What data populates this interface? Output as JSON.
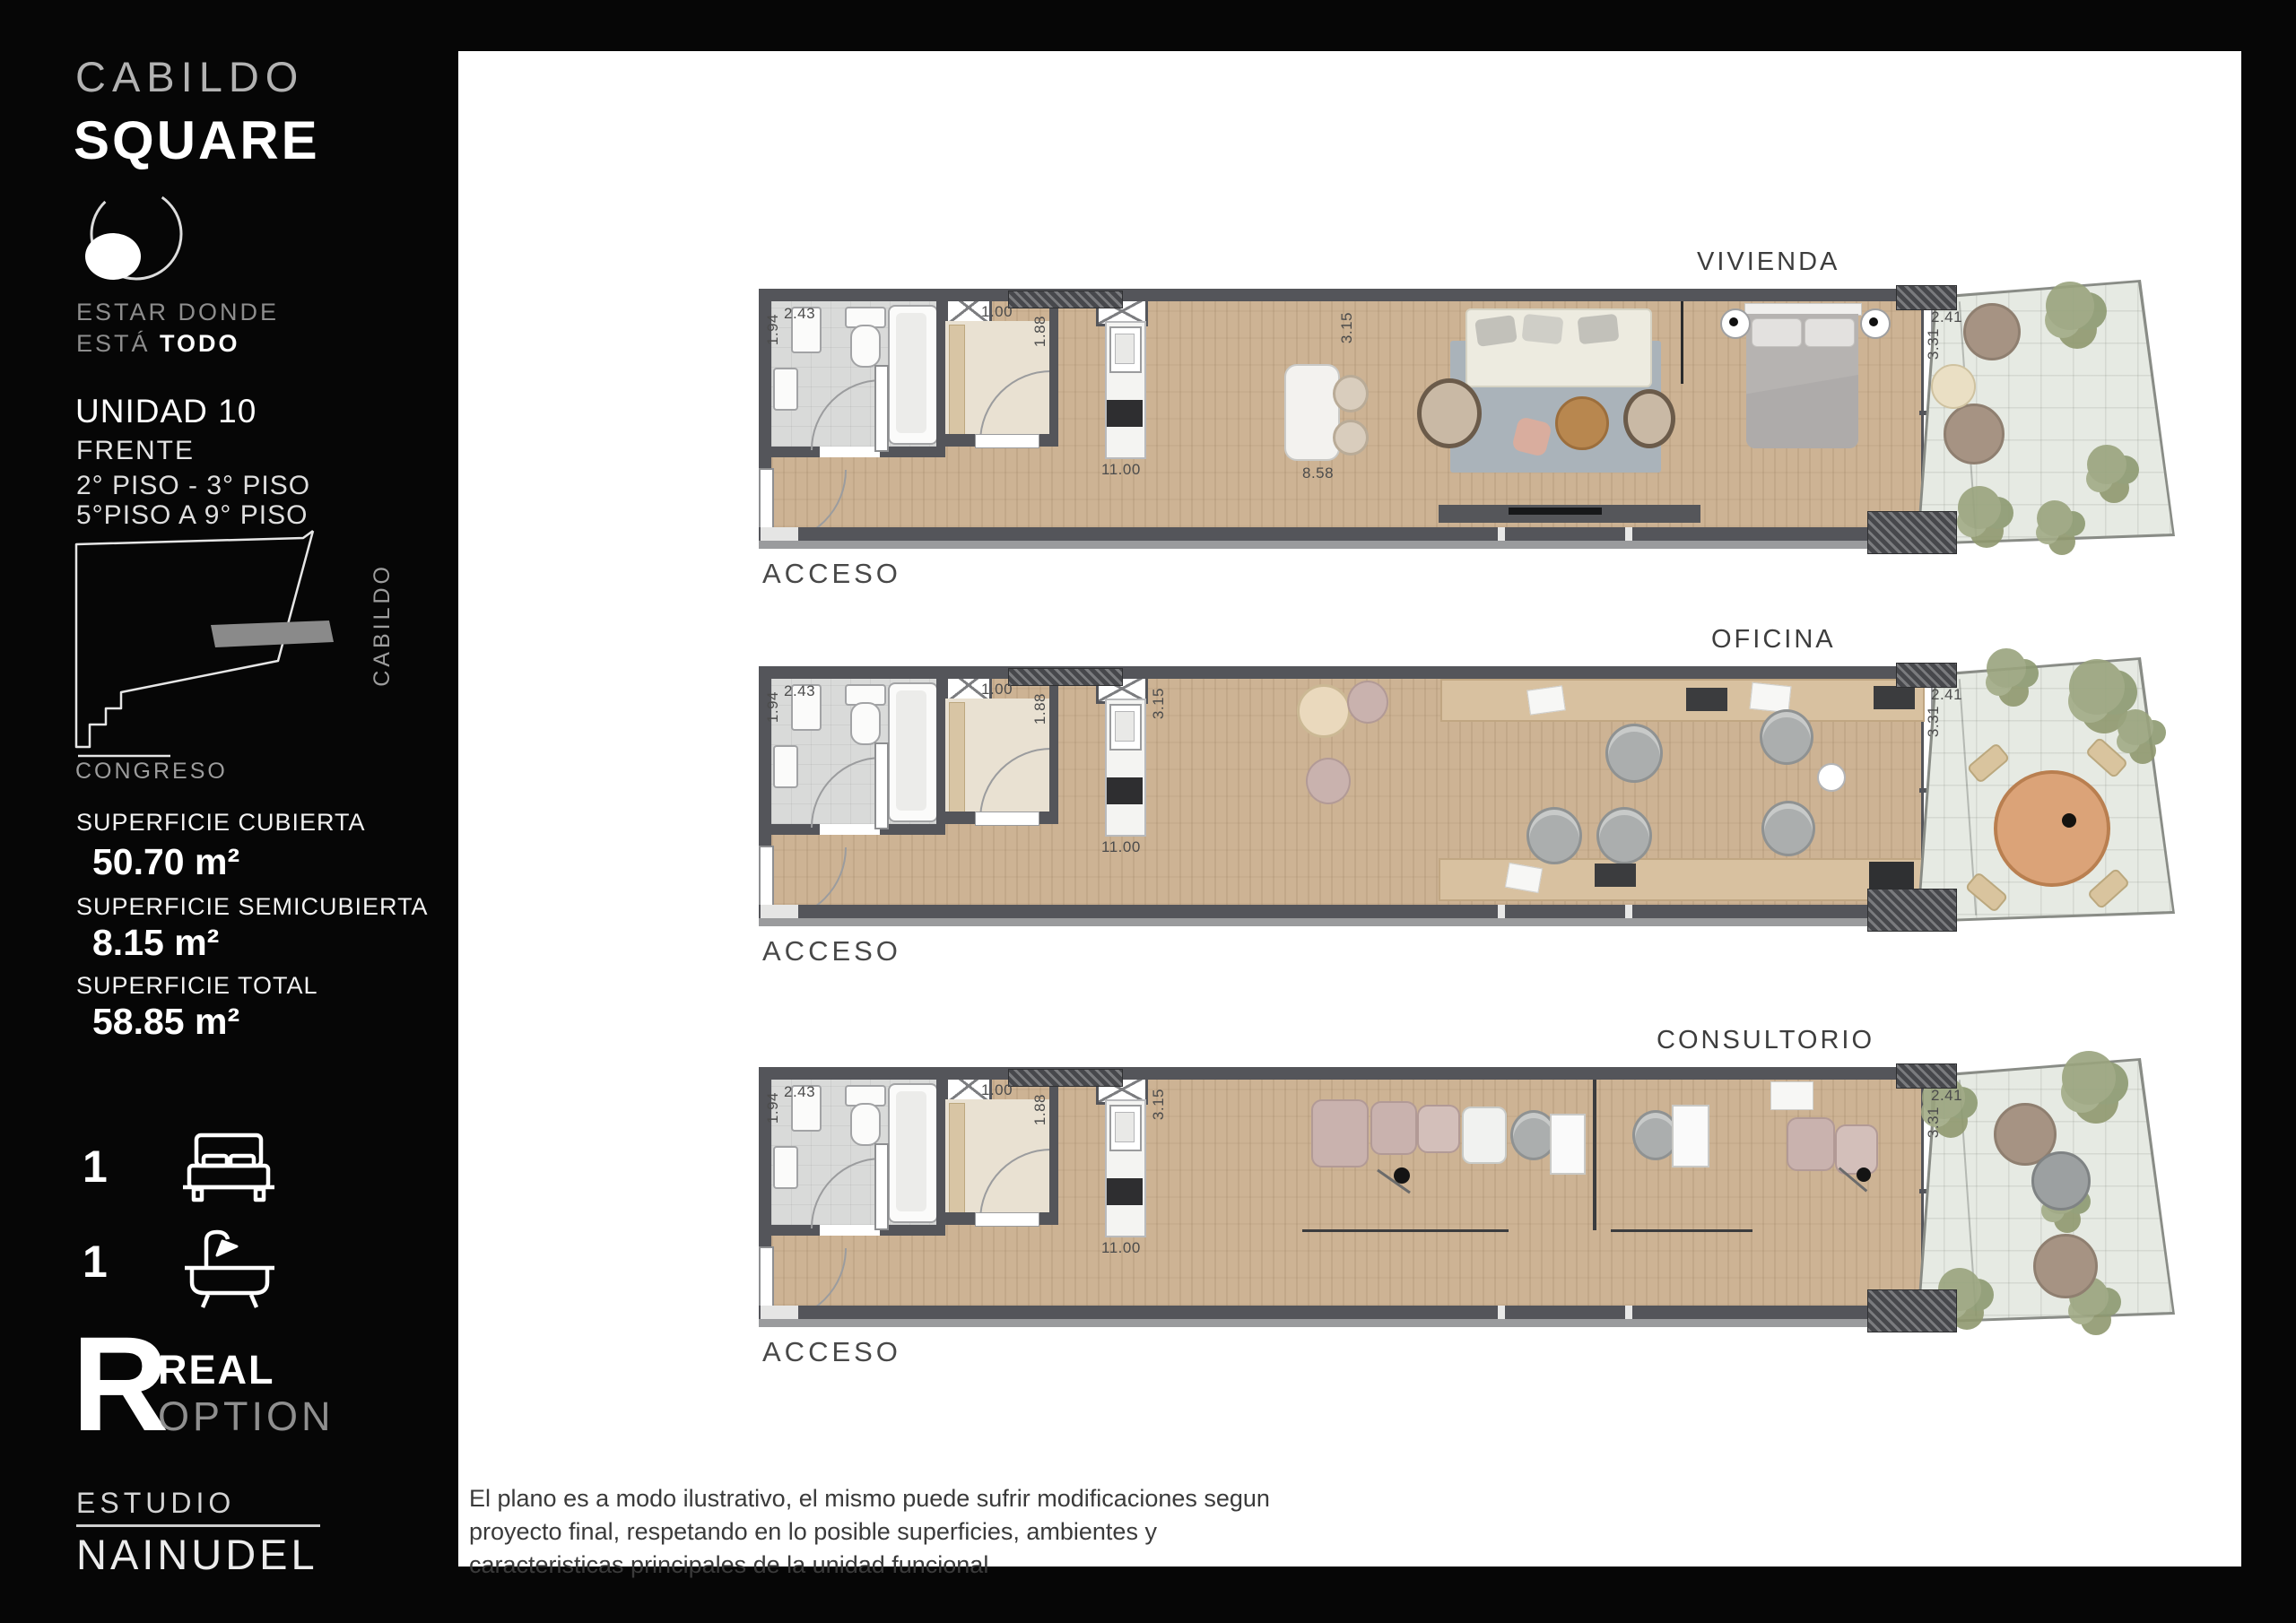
{
  "sidebar": {
    "brand_line1": "CABILDO",
    "brand_line2": "SQUARE",
    "tagline_line1": "ESTAR DONDE",
    "tagline_line2_gray": "ESTÁ ",
    "tagline_line2_bold": "TODO",
    "unit_title": "UNIDAD 10",
    "unit_subtitle": "FRENTE",
    "floors_line1": "2° PISO - 3° PISO",
    "floors_line2": "5°PISO A 9° PISO",
    "map": {
      "street_right": "CABILDO",
      "street_bottom": "CONGRESO"
    },
    "surfaces": [
      {
        "label": "SUPERFICIE CUBIERTA",
        "value": "50.70 m²"
      },
      {
        "label": "SUPERFICIE SEMICUBIERTA",
        "value": "8.15 m²"
      },
      {
        "label": "SUPERFICIE TOTAL",
        "value": "58.85  m²"
      }
    ],
    "amenities": [
      {
        "count": "1",
        "icon": "bed-icon"
      },
      {
        "count": "1",
        "icon": "bathtub-icon"
      }
    ],
    "broker_logo": {
      "letter": "R",
      "line1": "REAL",
      "line2": "OPTION"
    },
    "studio_logo": {
      "line1": "ESTUDIO",
      "line2": "NAINUDEL"
    }
  },
  "plans": [
    {
      "name": "VIVIENDA",
      "access_label": "ACCESO",
      "variant": "vivienda",
      "dims": {
        "bath_w": "1.94",
        "bath_l": "2.43",
        "closet_w": "1.00",
        "closet_l": "1.88",
        "unit_w": "3.15",
        "unit_l": "11.00",
        "living_l": "8.58",
        "terr_w": "2.41",
        "terr_l": "3.31"
      }
    },
    {
      "name": "OFICINA",
      "access_label": "ACCESO",
      "variant": "oficina",
      "dims": {
        "bath_w": "1.94",
        "bath_l": "2.43",
        "closet_w": "1.00",
        "closet_l": "1.88",
        "unit_w": "3.15",
        "unit_l": "11.00",
        "living_l": "",
        "terr_w": "2.41",
        "terr_l": "3.31"
      }
    },
    {
      "name": "CONSULTORIO",
      "access_label": "ACCESO",
      "variant": "consultorio",
      "dims": {
        "bath_w": "1.94",
        "bath_l": "2.43",
        "closet_w": "1.00",
        "closet_l": "1.88",
        "unit_w": "3.15",
        "unit_l": "11.00",
        "living_l": "",
        "terr_w": "2.41",
        "terr_l": "3.31"
      }
    }
  ],
  "disclaimer": {
    "lines": [
      "El plano es a modo ilustrativo, el mismo puede sufrir modificaciones segun",
      "proyecto final, respetando en lo posible superficies, ambientes y",
      "caracteristicas principales de la unidad funcional"
    ]
  },
  "colors": {
    "wall": "#54555a",
    "wood_floor": "#cdb394",
    "bath_floor": "#d9dad9",
    "terrace": "#e6eae3",
    "rug": "#aab3ba",
    "accent_pink": "#c9b2ae"
  }
}
